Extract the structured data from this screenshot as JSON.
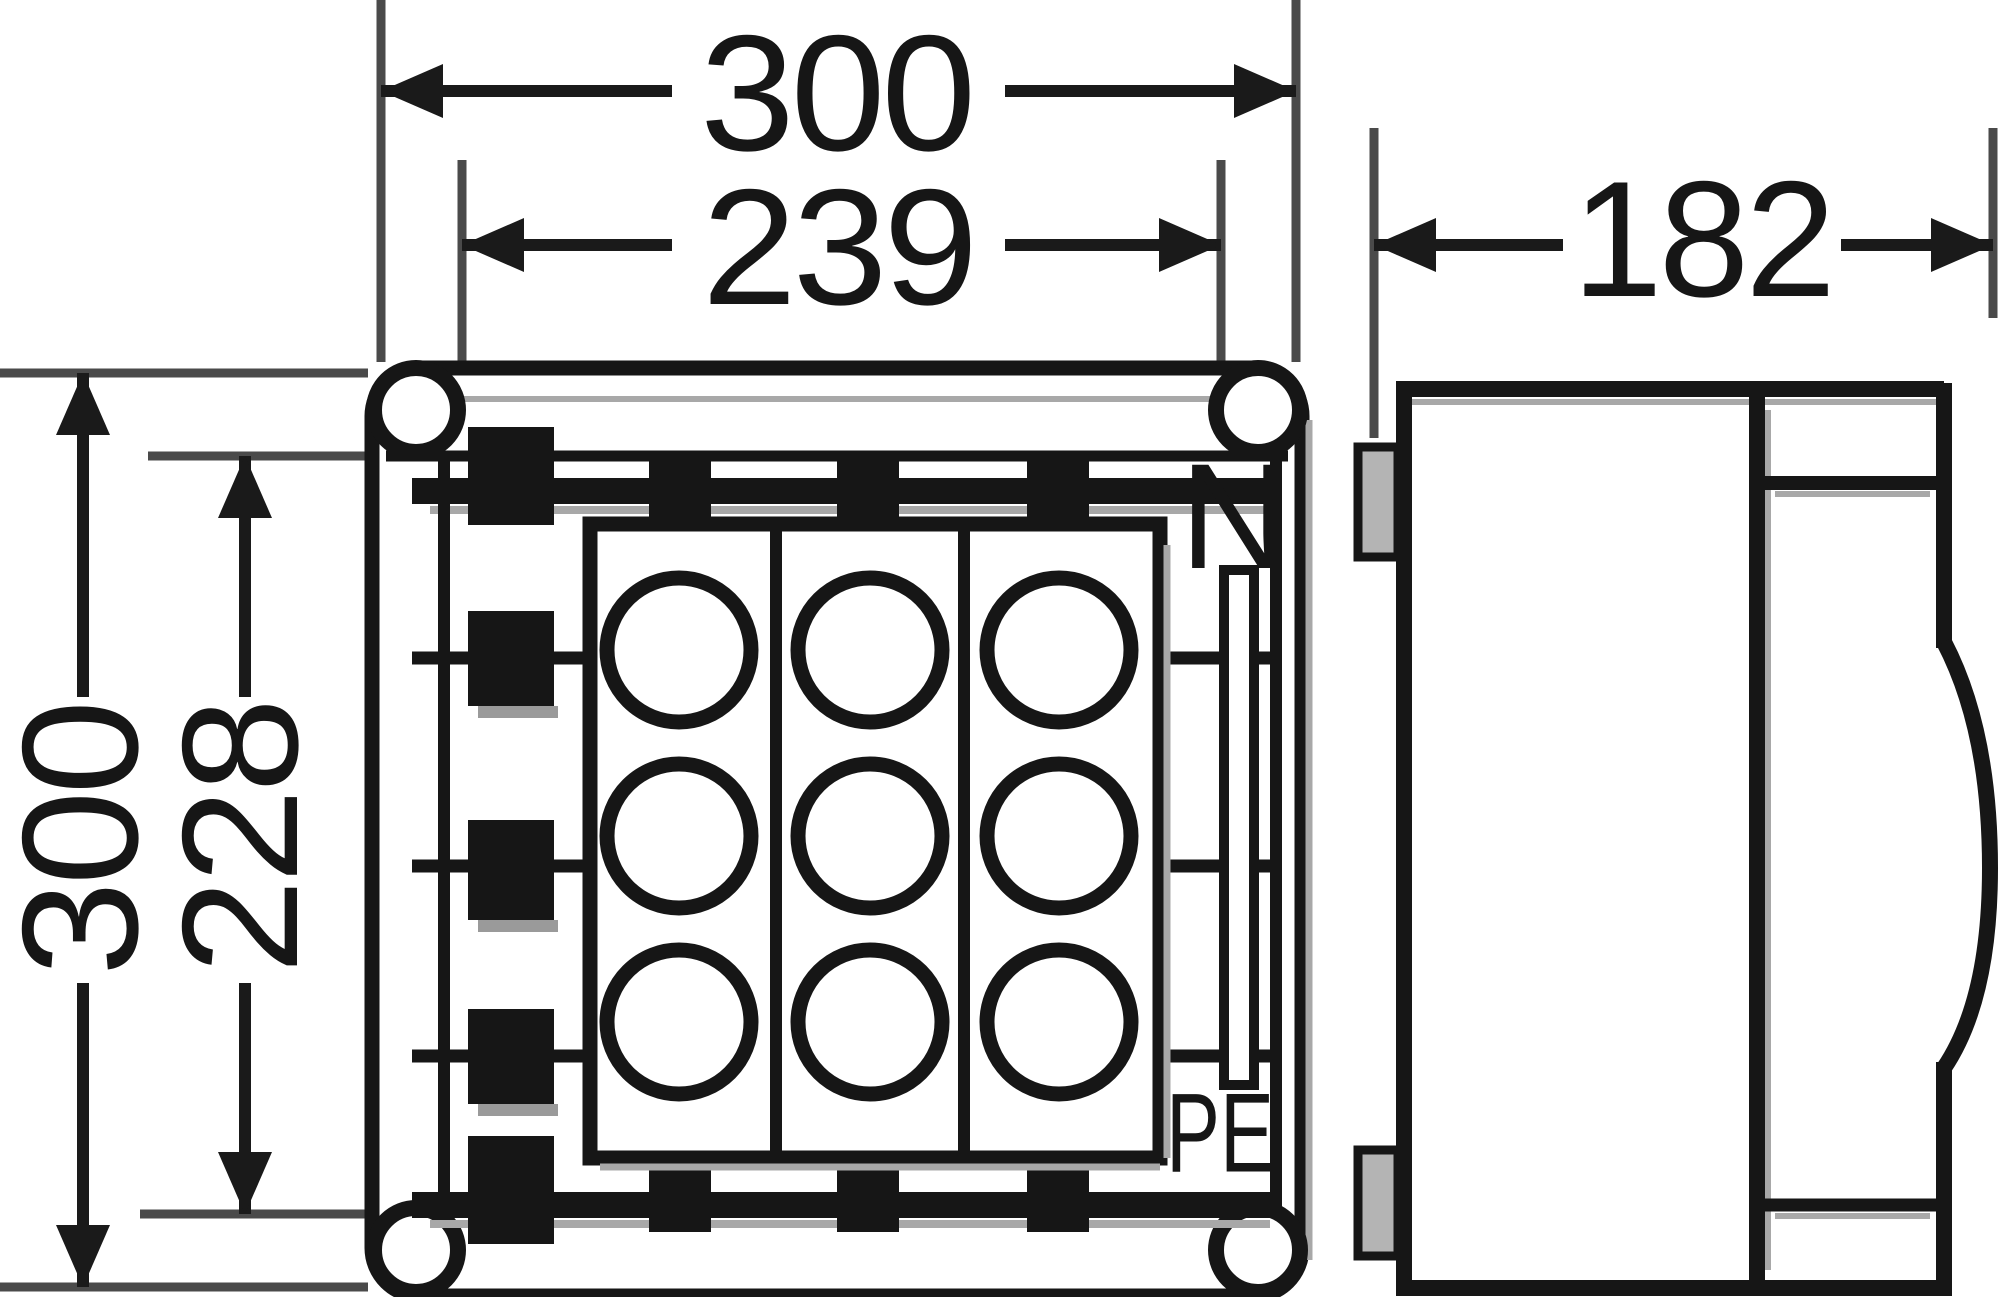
{
  "drawing": {
    "type": "enclosure-dimension-drawing",
    "views": {
      "front_view_name": "front view",
      "side_view_name": "side view"
    },
    "dimensions": {
      "outer_width": "300",
      "inner_width": "239",
      "outer_height": "300",
      "inner_height": "228",
      "depth": "182"
    },
    "terminals": {
      "neutral": "N",
      "earth": "PE"
    },
    "features": {
      "cable_entries_rows": 3,
      "cable_entries_cols": 3,
      "corner_screws": 4
    },
    "colors": {
      "line": "#161616",
      "extension_line": "#4a4a4a",
      "shadow": "#a8a8a8",
      "lug_fill": "#b4b4b4",
      "background": "#ffffff"
    }
  }
}
